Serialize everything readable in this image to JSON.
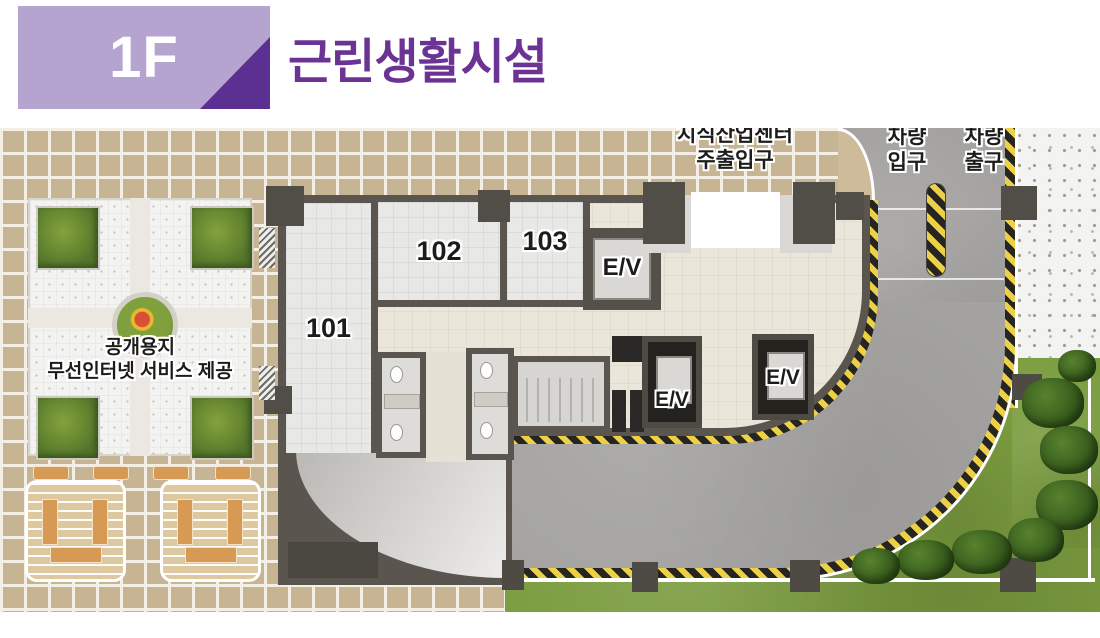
{
  "header": {
    "floor_badge": "1F",
    "title": "근린생활시설"
  },
  "labels": {
    "entrance_line1": "지식산업센터",
    "entrance_line2": "주출입구",
    "vehicle_in_line1": "차량",
    "vehicle_in_line2": "입구",
    "vehicle_out_line1": "차량",
    "vehicle_out_line2": "출구",
    "public_line1": "공개용지",
    "public_line2": "무선인터넷 서비스 제공"
  },
  "rooms": [
    "101",
    "102",
    "103"
  ],
  "elevators": [
    "E/V",
    "E/V",
    "E/V"
  ],
  "colors": {
    "badge_bg": "#b5a3d0",
    "badge_triangle": "#5c3092",
    "title": "#6b3494",
    "hazard_yellow": "#ecd045",
    "hazard_black": "#262521",
    "road": "#a4a3a1",
    "grass": "#7b9c3f",
    "tile_tan": "#c7b492",
    "wall": "#5a564f",
    "lobby_floor": "#eae6da"
  }
}
